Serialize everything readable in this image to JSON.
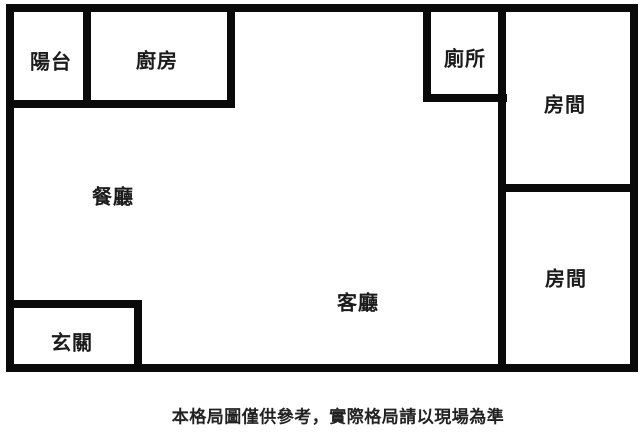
{
  "floor_plan": {
    "background_color": "#ffffff",
    "wall_color": "#0a0a0a",
    "rooms": [
      {
        "id": "balcony",
        "label": "陽台"
      },
      {
        "id": "kitchen",
        "label": "廚房"
      },
      {
        "id": "toilet",
        "label": "廁所"
      },
      {
        "id": "bedroom-top",
        "label": "房間"
      },
      {
        "id": "dining",
        "label": "餐廳"
      },
      {
        "id": "living",
        "label": "客廳"
      },
      {
        "id": "bedroom-bottom",
        "label": "房間"
      },
      {
        "id": "entrance",
        "label": "玄關"
      }
    ],
    "disclaimer": "本格局圖僅供參考，實際格局請以現場為準"
  }
}
